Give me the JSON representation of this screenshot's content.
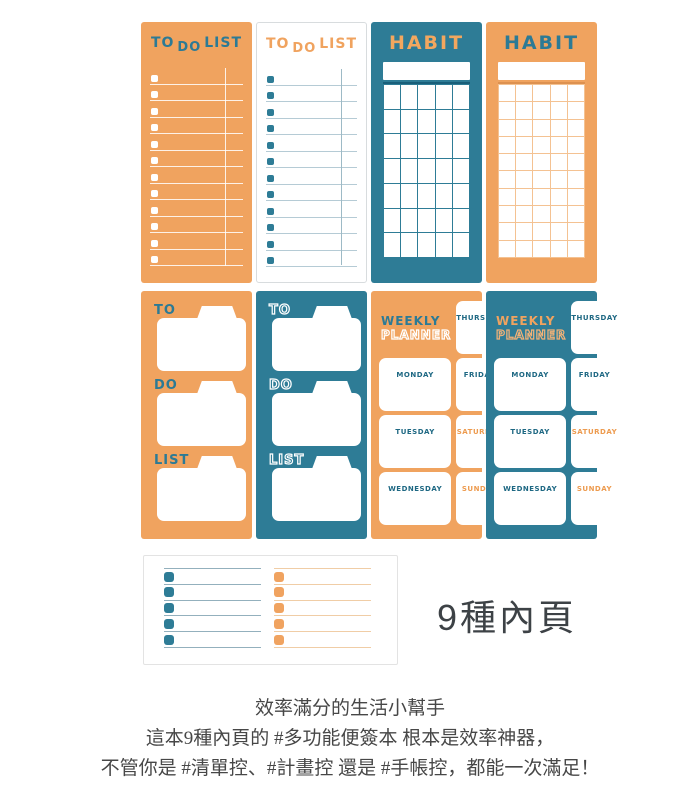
{
  "colors": {
    "orange": "#F0A35F",
    "teal": "#2E7C96",
    "dark_teal": "#1E6883",
    "weekend_orange": "#ED9B4F",
    "caption_text": "#3d4246",
    "description_text": "#474747"
  },
  "pads": {
    "todo_title": [
      "TO",
      "DO",
      "LIST"
    ],
    "todo_rows": 12,
    "habit_title": "HABIT",
    "habit_grid_teal": {
      "cols": 5,
      "rows": 7
    },
    "habit_grid_orange": {
      "cols": 5,
      "rows": 10
    },
    "folder_labels": [
      "TO",
      "DO",
      "LIST"
    ],
    "weekly_title": [
      "WEEKLY",
      "PLANNER"
    ],
    "days_left": [
      "MONDAY",
      "TUESDAY",
      "WEDNESDAY"
    ],
    "days_right": [
      "THURSDAY",
      "FRIDAY",
      "SATURDAY",
      "SUNDAY"
    ]
  },
  "summary": {
    "rows_per_column": 5
  },
  "caption": "9種內頁",
  "description": [
    "效率滿分的生活小幫手",
    "這本9種內頁的 #多功能便簽本 根本是效率神器，",
    "不管你是 #清單控、#計畫控 還是 #手帳控，都能一次滿足！"
  ]
}
